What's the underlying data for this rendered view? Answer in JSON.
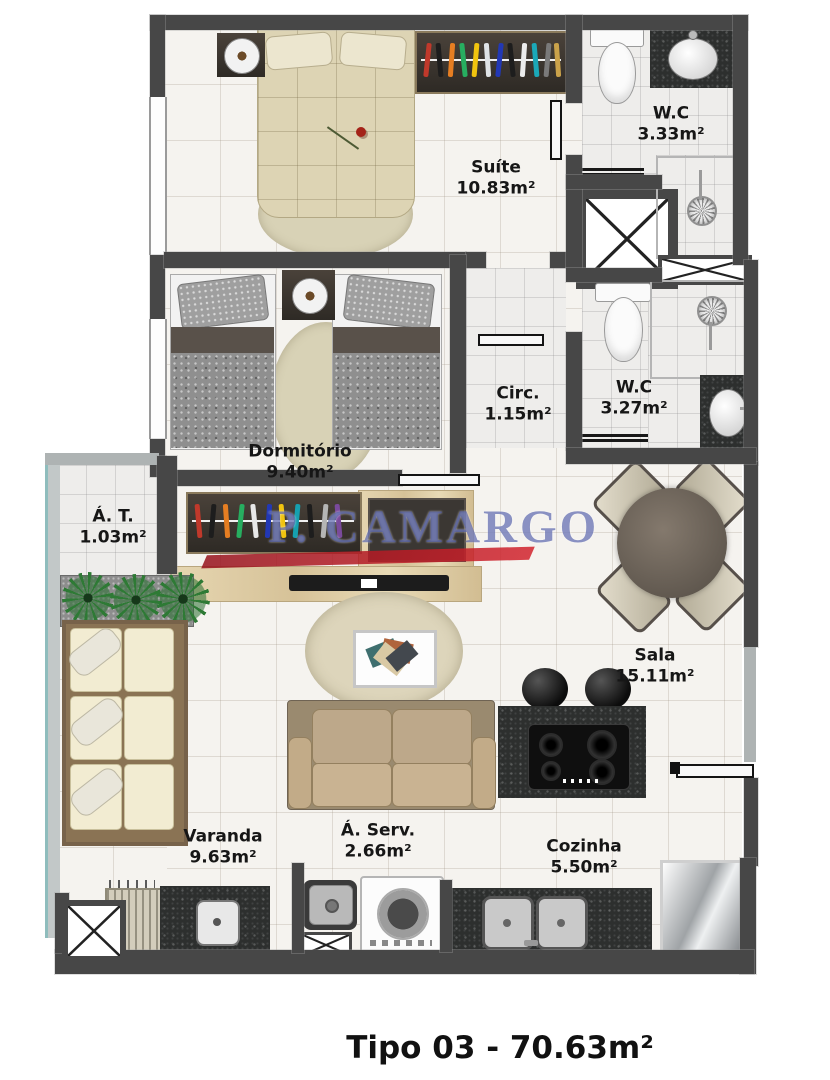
{
  "title": "Tipo 03 - 70.63m²",
  "watermark": {
    "text": "P. CAMARGO",
    "color": "#4450a2",
    "accent": "#c4232b"
  },
  "rooms": {
    "suite": {
      "name": "Suíte",
      "area": "10.83m²"
    },
    "wc1": {
      "name": "W.C",
      "area": "3.33m²"
    },
    "wc2": {
      "name": "W.C",
      "area": "3.27m²"
    },
    "circ": {
      "name": "Circ.",
      "area": "1.15m²"
    },
    "dormitorio": {
      "name": "Dormitório",
      "area": "9.40m²"
    },
    "at": {
      "name": "Á. T.",
      "area": "1.03m²"
    },
    "sala": {
      "name": "Sala",
      "area": "15.11m²"
    },
    "varanda": {
      "name": "Varanda",
      "area": "9.63m²"
    },
    "aserv": {
      "name": "Á. Serv.",
      "area": "2.66m²"
    },
    "cozinha": {
      "name": "Cozinha",
      "area": "5.50m²"
    }
  },
  "colors": {
    "wall": "#474747",
    "floor": "#f5f3ef",
    "counter_granite": "#2d2f2e",
    "wood": "#d9c6a0",
    "sofa_beige": "#b49b79",
    "plant_green": "#2e7a35",
    "label_text": "#161616"
  }
}
